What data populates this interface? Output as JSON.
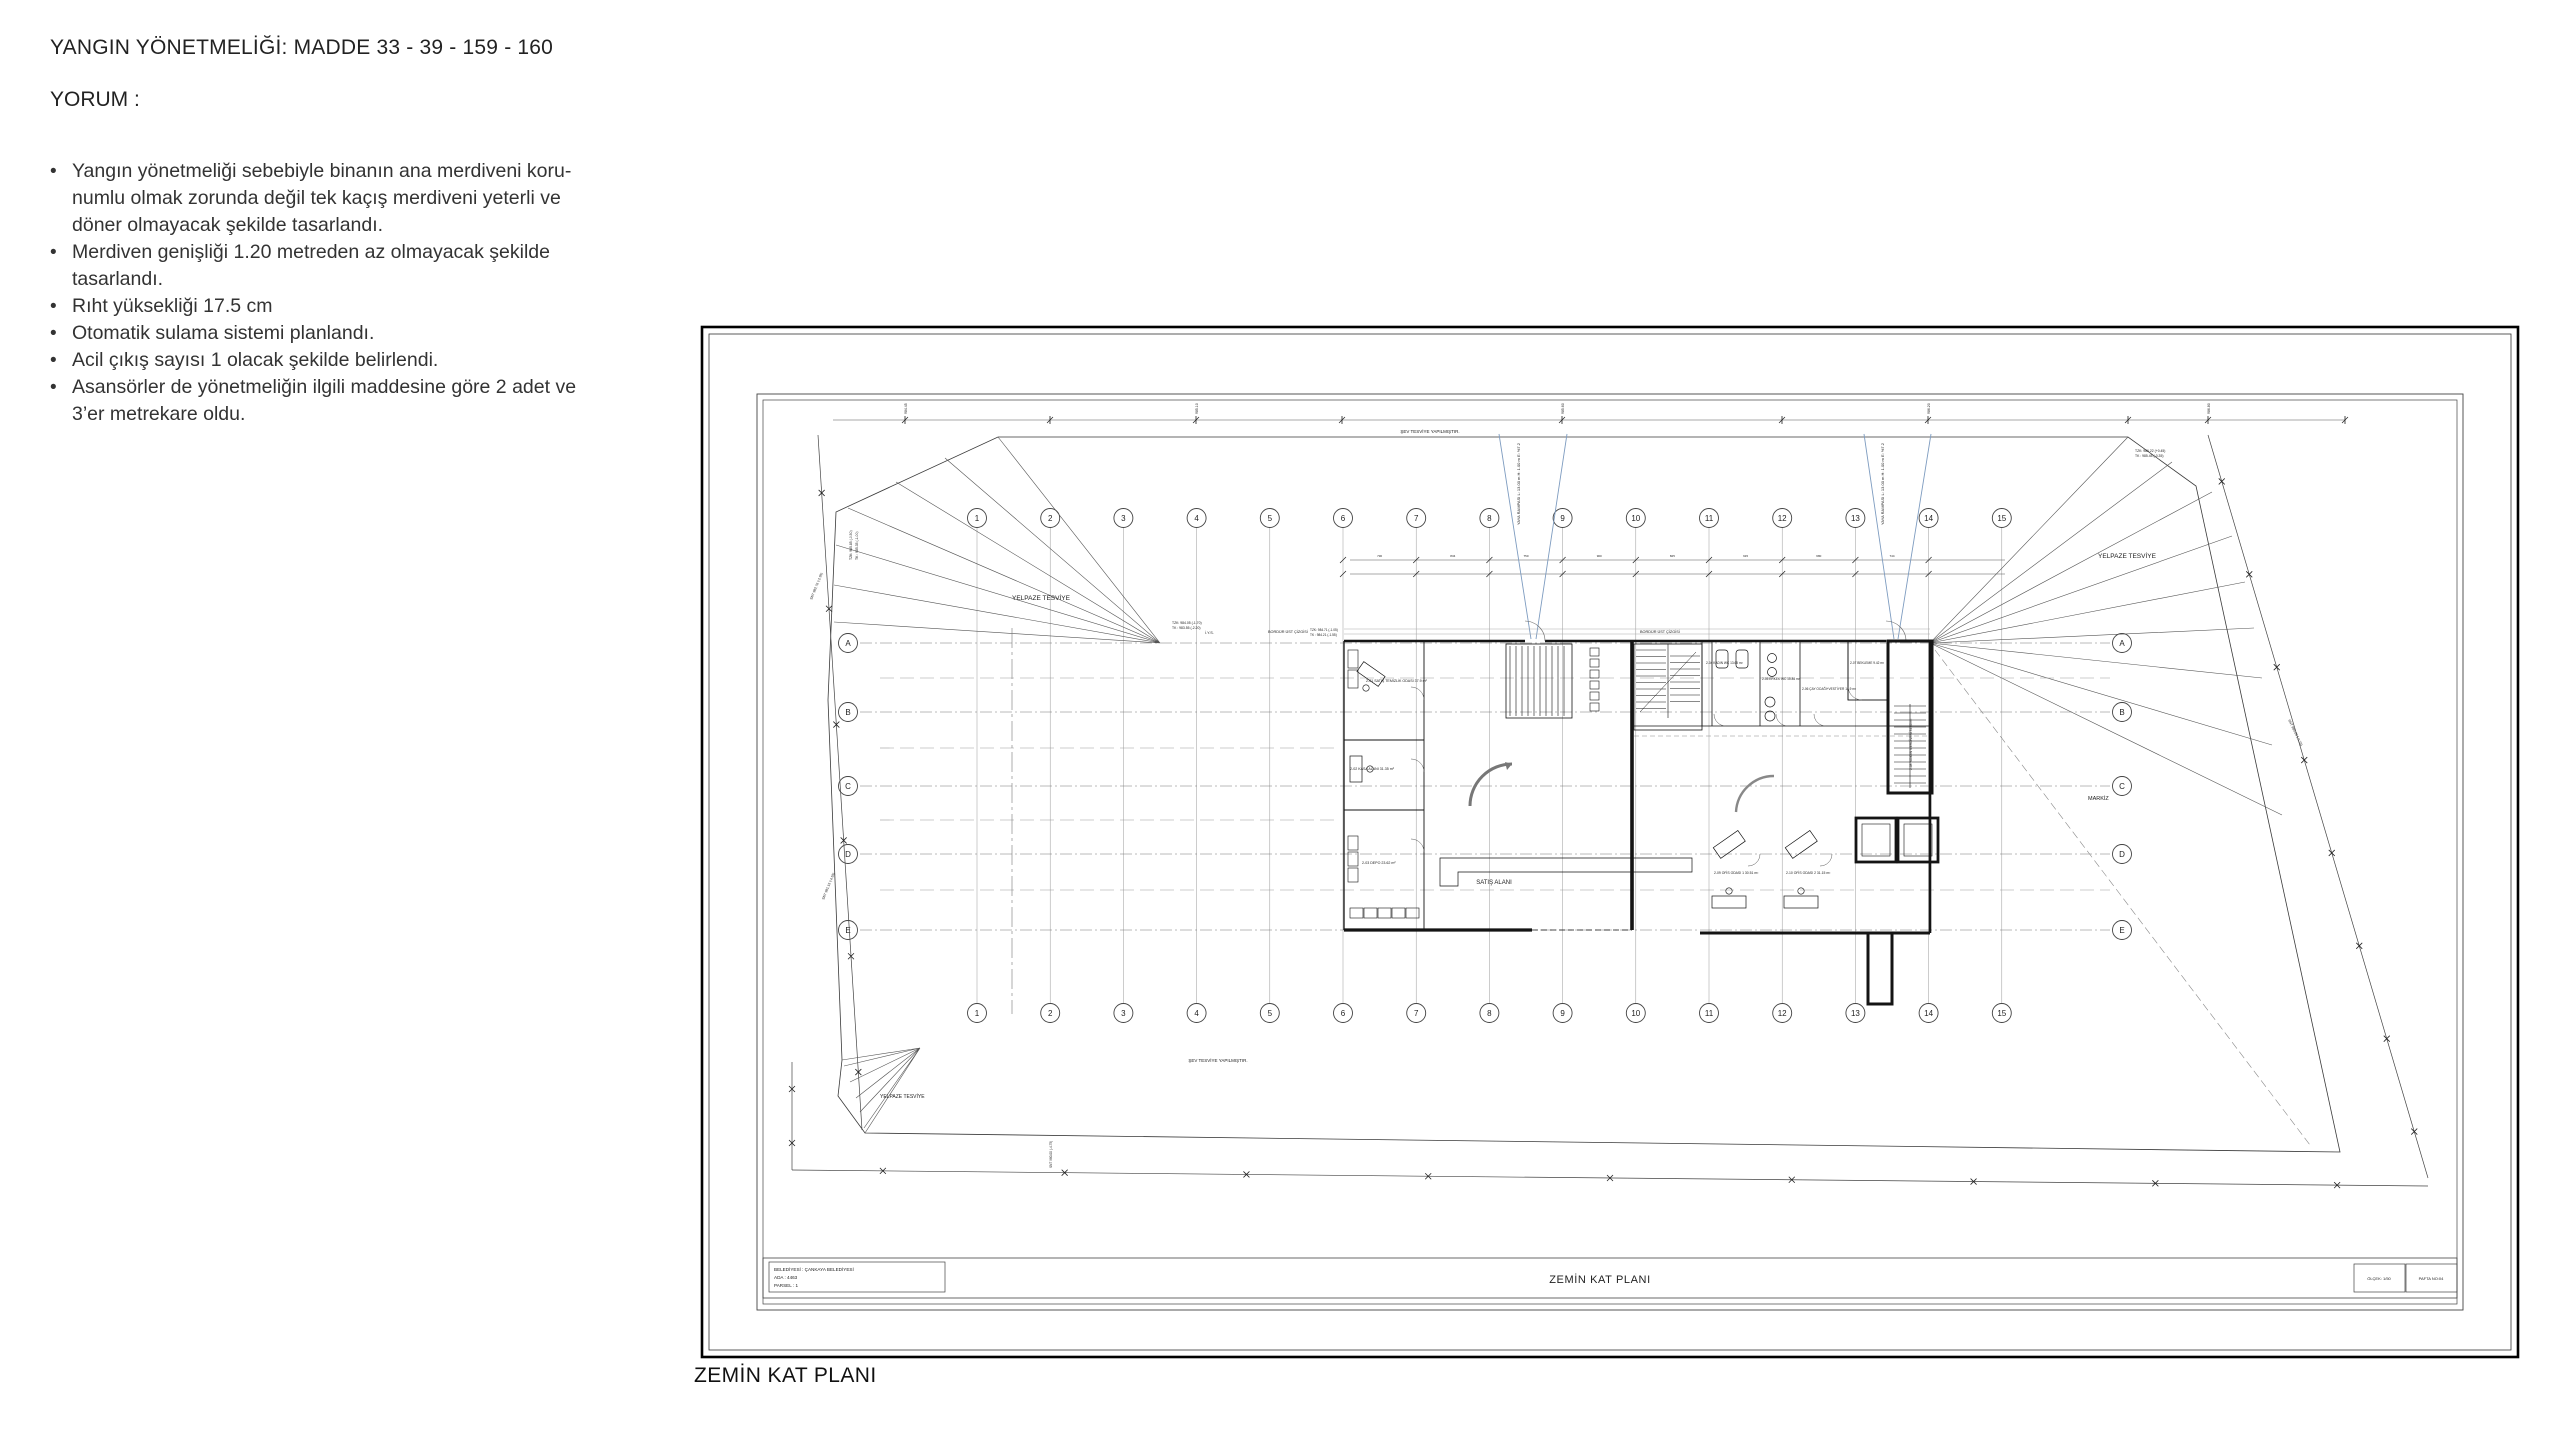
{
  "notes": {
    "title": "YANGIN YÖNETMELİĞİ: MADDE 33 - 39 - 159 - 160",
    "subtitle": "YORUM :",
    "bullet_char": "•",
    "bullets": [
      "Yangın yönetmeliği sebebiyle binanın ana merdiveni koru-\nnumlu olmak zorunda değil tek kaçış merdiveni yeterli ve\ndöner olmayacak şekilde tasarlandı.",
      "Merdiven genişliği 1.20 metreden az olmayacak şekilde\ntasarlandı.",
      "Rıht yüksekliği 17.5 cm",
      "Otomatik sulama sistemi planlandı.",
      "Acil çıkış sayısı 1 olacak şekilde belirlendi.",
      "Asansörler de yönetmeliğin ilgili maddesine göre 2 adet ve\n3’er metrekare oldu."
    ]
  },
  "caption": "ZEMİN KAT PLANI",
  "plan": {
    "columns": [
      "1",
      "2",
      "3",
      "4",
      "5",
      "6",
      "7",
      "8",
      "9",
      "10",
      "11",
      "12",
      "13",
      "14",
      "15"
    ],
    "rows": [
      "A",
      "B",
      "C",
      "D",
      "E"
    ],
    "labels": {
      "yelpaze_top_left": "YELPAZE TESVİYE",
      "yelpaze_right": "YELPAZE TESVİYE",
      "yelpaze_bottom_left": "YELPAZE TESVİYE",
      "sev_top": "ŞEV TESVİYE YAPILMIŞTIR.",
      "sev_bottom": "ŞEV TESVİYE YAPILMIŞTIR.",
      "markiz": "MARKİZ",
      "satis_alani": "SATIŞ ALANI",
      "iys": "İ.Y.S.",
      "bordur_1": "BORDÜR ÜST ÇİZGİSİ",
      "bordur_2": "BORDÜR ÜST ÇİZGİSİ",
      "ramp_1": "YAYA RAMPASI  L: 13.00 m  H: 1.00 m  E: %7.2",
      "ramp_2": "YAYA RAMPASI  L: 13.00 m  H: 1.00 m  E: %7.2"
    },
    "rooms": [
      "2-01 SATIŞ TEMİZLİK ODASI 37.9 m²",
      "2-02 KASA ALANI 31.35 m²",
      "2-03 DEPO 23.62 m²",
      "2-04 KADIN WC 13.65 m²",
      "2-05 ERKEK WC 15.84 m²",
      "2-06 ÇAY OCAĞI+VESTİYER 14.9 m²",
      "2-07 BEKLEME 9.42 m²",
      "2-08 YANGIN MERDİVENİ 34.80 m²",
      "2-09 OFİS ODASI 1 30.51 m²",
      "2-10 OFİS ODASI 2 31.15 m²"
    ],
    "survey_notes": [
      "TZK: 984.05 (-1.70)",
      "TK : 983.55 (-2.20)",
      "TZK: 985.85 (-0.50)",
      "TK : 985.35 (-1.00)",
      "SNT 982.76 (-2.95)",
      "SNT 981.15 (-4.55)",
      "TZK: 986.22 (+0.45)",
      "TK : 985.45 (-0.35)",
      "SNT 985.05 (-0.75)",
      "SNT 980.00 (-4.75)",
      "TZK: 984.71 (-1.05)",
      "TK : 984.21 (-1.55)"
    ],
    "elevations": [
      "984.45",
      "985.10",
      "985.60",
      "986.20",
      "986.80"
    ],
    "dims": [
      "730",
      "834",
      "750",
      "900",
      "825",
      "915",
      "680",
      "744",
      "812"
    ],
    "title_block": {
      "line1": "BELEDİYESİ :  ÇANKAYA BELEDİYESİ",
      "line2": "ADA             :  4463",
      "line3": "PARSEL       :  1",
      "drawing_title": "ZEMİN KAT PLANI",
      "scale": "ÖLÇEK: 1/50",
      "sheet": "PAFTA NO:04"
    },
    "colors": {
      "ramp_blue": "#7e9cc0",
      "line_dark": "#1c1c1c"
    }
  }
}
